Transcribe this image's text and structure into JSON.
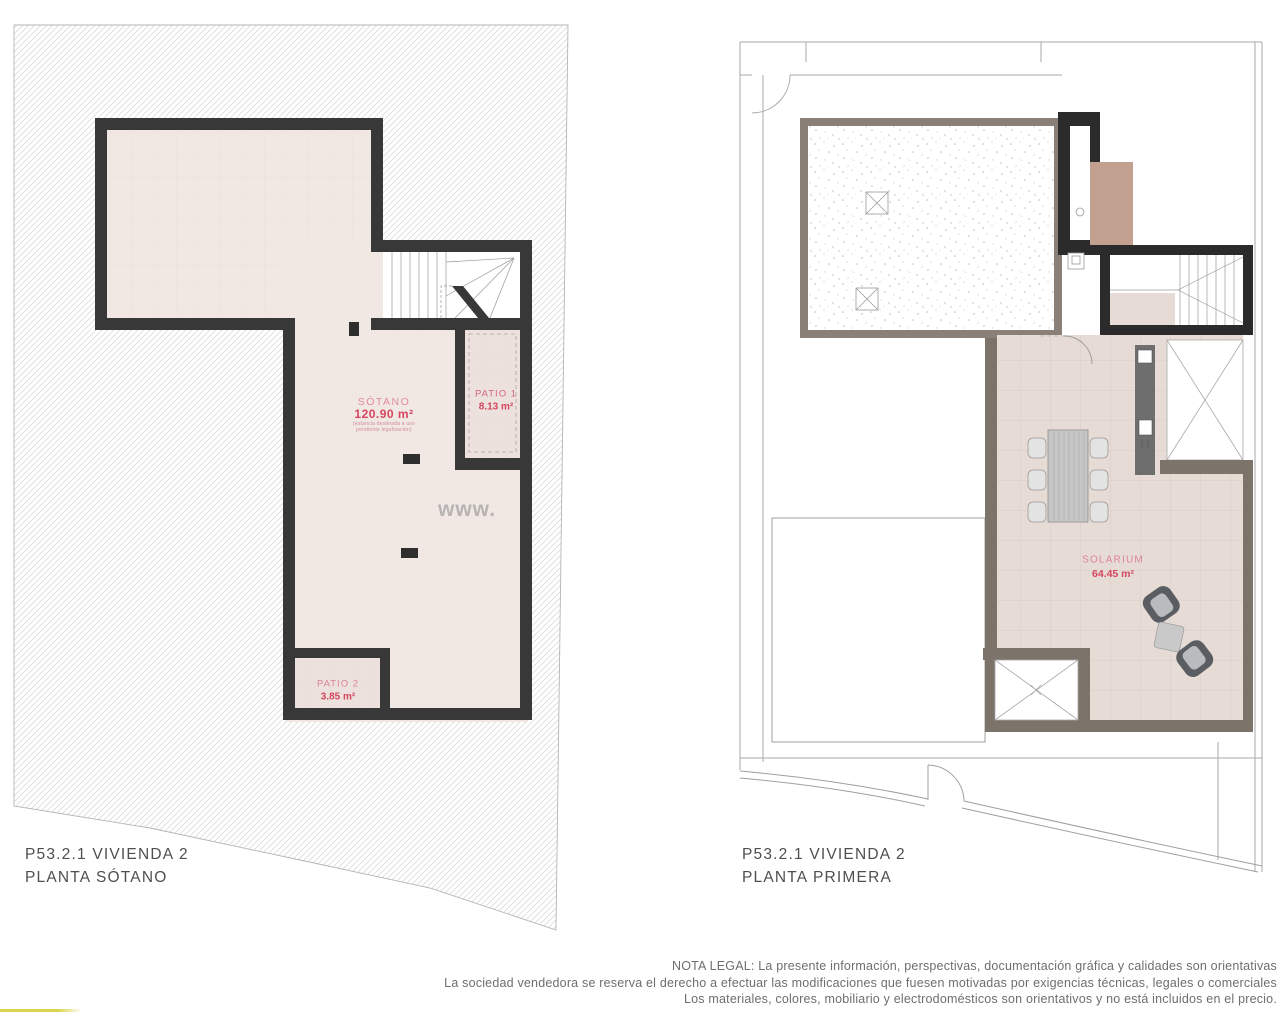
{
  "watermark": "www.",
  "left_plan": {
    "title_line1": "P53.2.1 VIVIENDA 2",
    "title_line2": "PLANTA SÓTANO",
    "rooms": {
      "sotano": {
        "name": "SÓTANO",
        "area": "120.90 m²",
        "note1": "(estancia destinada a uso",
        "note2": "pendiente legalización)"
      },
      "patio1": {
        "name": "PATIO 1",
        "area": "8.13 m²"
      },
      "patio2": {
        "name": "PATIO 2",
        "area": "3.85 m²"
      }
    }
  },
  "right_plan": {
    "title_line1": "P53.2.1 VIVIENDA 2",
    "title_line2": "PLANTA PRIMERA",
    "rooms": {
      "solarium": {
        "name": "SOLARIUM",
        "area": "64.45 m²"
      }
    }
  },
  "legal": {
    "line1": "NOTA LEGAL: La presente información, perspectivas, documentación gráfica y calidades son orientativas",
    "line2": "La sociedad vendedora se reserva el derecho a efectuar las modificaciones que fuesen motivadas por exigencias técnicas, legales o comerciales",
    "line3": "Los materiales, colores, mobiliario y electrodomésticos son orientativos y no está incluidos en el precio."
  },
  "colors": {
    "accent_red": "#d4465f",
    "accent_pink": "#e08ca0",
    "wall_dark": "#383838",
    "wall_black": "#2b2b2b",
    "wall_taupe": "#7c736b",
    "terrace_border": "#8a8078",
    "floor_beige": "#f1e8e4",
    "floor_solarium": "#e7dcd5",
    "tan_block": "#c2a191",
    "yellow_bar": "#d9d44b"
  }
}
